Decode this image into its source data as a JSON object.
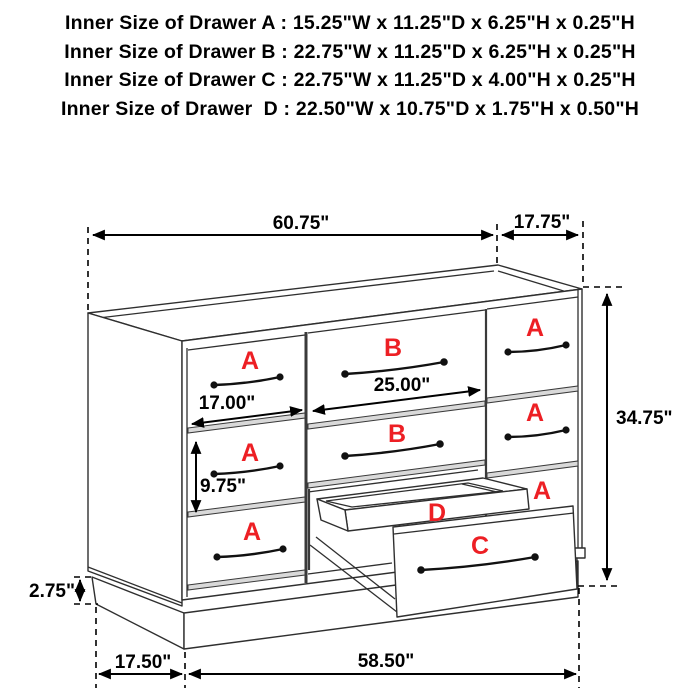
{
  "header": {
    "lines": [
      "Inner Size of Drawer A : 15.25\"W x 11.25\"D x 6.25\"H x 0.25\"H",
      "Inner Size of Drawer B : 22.75\"W x 11.25\"D x 6.25\"H x 0.25\"H",
      "Inner Size of Drawer C : 22.75\"W x 11.25\"D x 4.00\"H x 0.25\"H",
      "Inner Size of Drawer  D : 22.50\"W x 10.75\"D x 1.75\"H x 0.50\"H"
    ]
  },
  "diagram": {
    "accent_red": "#ed1f24",
    "line_color": "#2f2f2f",
    "dim_labels": {
      "overall_width": "60.75\"",
      "top_depth": "17.75\"",
      "overall_height": "34.75\"",
      "drawer_a_width": "17.00\"",
      "drawer_b_width": "25.00\"",
      "drawer_a_height": "9.75\"",
      "base_height": "2.75\"",
      "base_side_depth": "17.50\"",
      "base_front_width": "58.50\""
    },
    "drawer_letters": {
      "a": "A",
      "b": "B",
      "c": "C",
      "d": "D"
    }
  }
}
